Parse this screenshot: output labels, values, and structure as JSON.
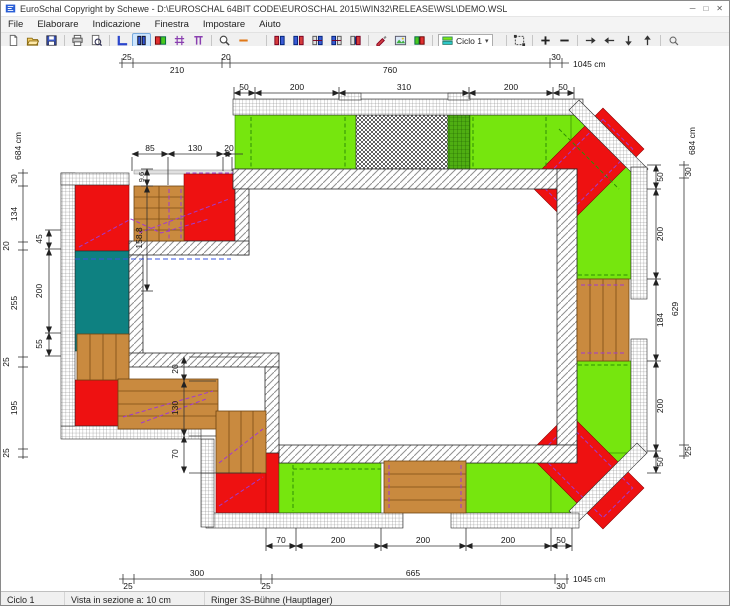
{
  "window": {
    "title": "EuroSchal Copyright by Schewe - D:\\EUROSCHAL 64BIT CODE\\EUROSCHAL 2015\\WIN32\\RELEASE\\WSL\\DEMO.WSL",
    "controls": {
      "minimize": "─",
      "maximize": "□",
      "close": "✕"
    }
  },
  "menu": {
    "items": [
      "File",
      "Elaborare",
      "Indicazione",
      "Finestra",
      "Impostare",
      "Aiuto"
    ]
  },
  "toolbar": {
    "ciclo_label": "Ciclo 1",
    "ciclo_caret": "▾"
  },
  "statusbar": {
    "cycle": "Ciclo 1",
    "view": "Vista in sezione a: 10 cm",
    "system": "Ringer 3S-Bühne (Hauptlager)"
  },
  "colors": {
    "panel_green": "#76e60e",
    "panel_red": "#ee1111",
    "panel_teal": "#0e8181",
    "platform_wood": "#c98a3f",
    "selection": "#cde6ff"
  },
  "dims": {
    "top_outer": {
      "s25": "25",
      "s210": "210",
      "s20": "20",
      "s760": "760",
      "s30": "30",
      "total": "1045 cm"
    },
    "top_inner": [
      "50",
      "200",
      "310",
      "200",
      "50"
    ],
    "left_outer": {
      "total": "684 cm",
      "s30": "30",
      "s134": "134",
      "s20": "20",
      "s255": "255",
      "s25a": "25",
      "s195": "195",
      "s25b": "25"
    },
    "left_inner": [
      "45",
      "200",
      "55"
    ],
    "alcove": {
      "s85": "85",
      "s130": "130",
      "s20": "20",
      "s96": "9.6",
      "s1588": "158.8"
    },
    "step": {
      "s20": "20",
      "s130": "130",
      "s70": "70"
    },
    "right_outer": {
      "total": "684 cm",
      "s30": "30",
      "s629": "629",
      "s25": "25"
    },
    "right_inner": [
      "50",
      "200",
      "184",
      "200",
      "50"
    ],
    "bottom_inner": [
      "70",
      "200",
      "200",
      "200",
      "50"
    ],
    "bottom_outer": {
      "s25a": "25",
      "s300": "300",
      "s25b": "25",
      "s665": "665",
      "s30": "30",
      "total": "1045 cm"
    }
  }
}
